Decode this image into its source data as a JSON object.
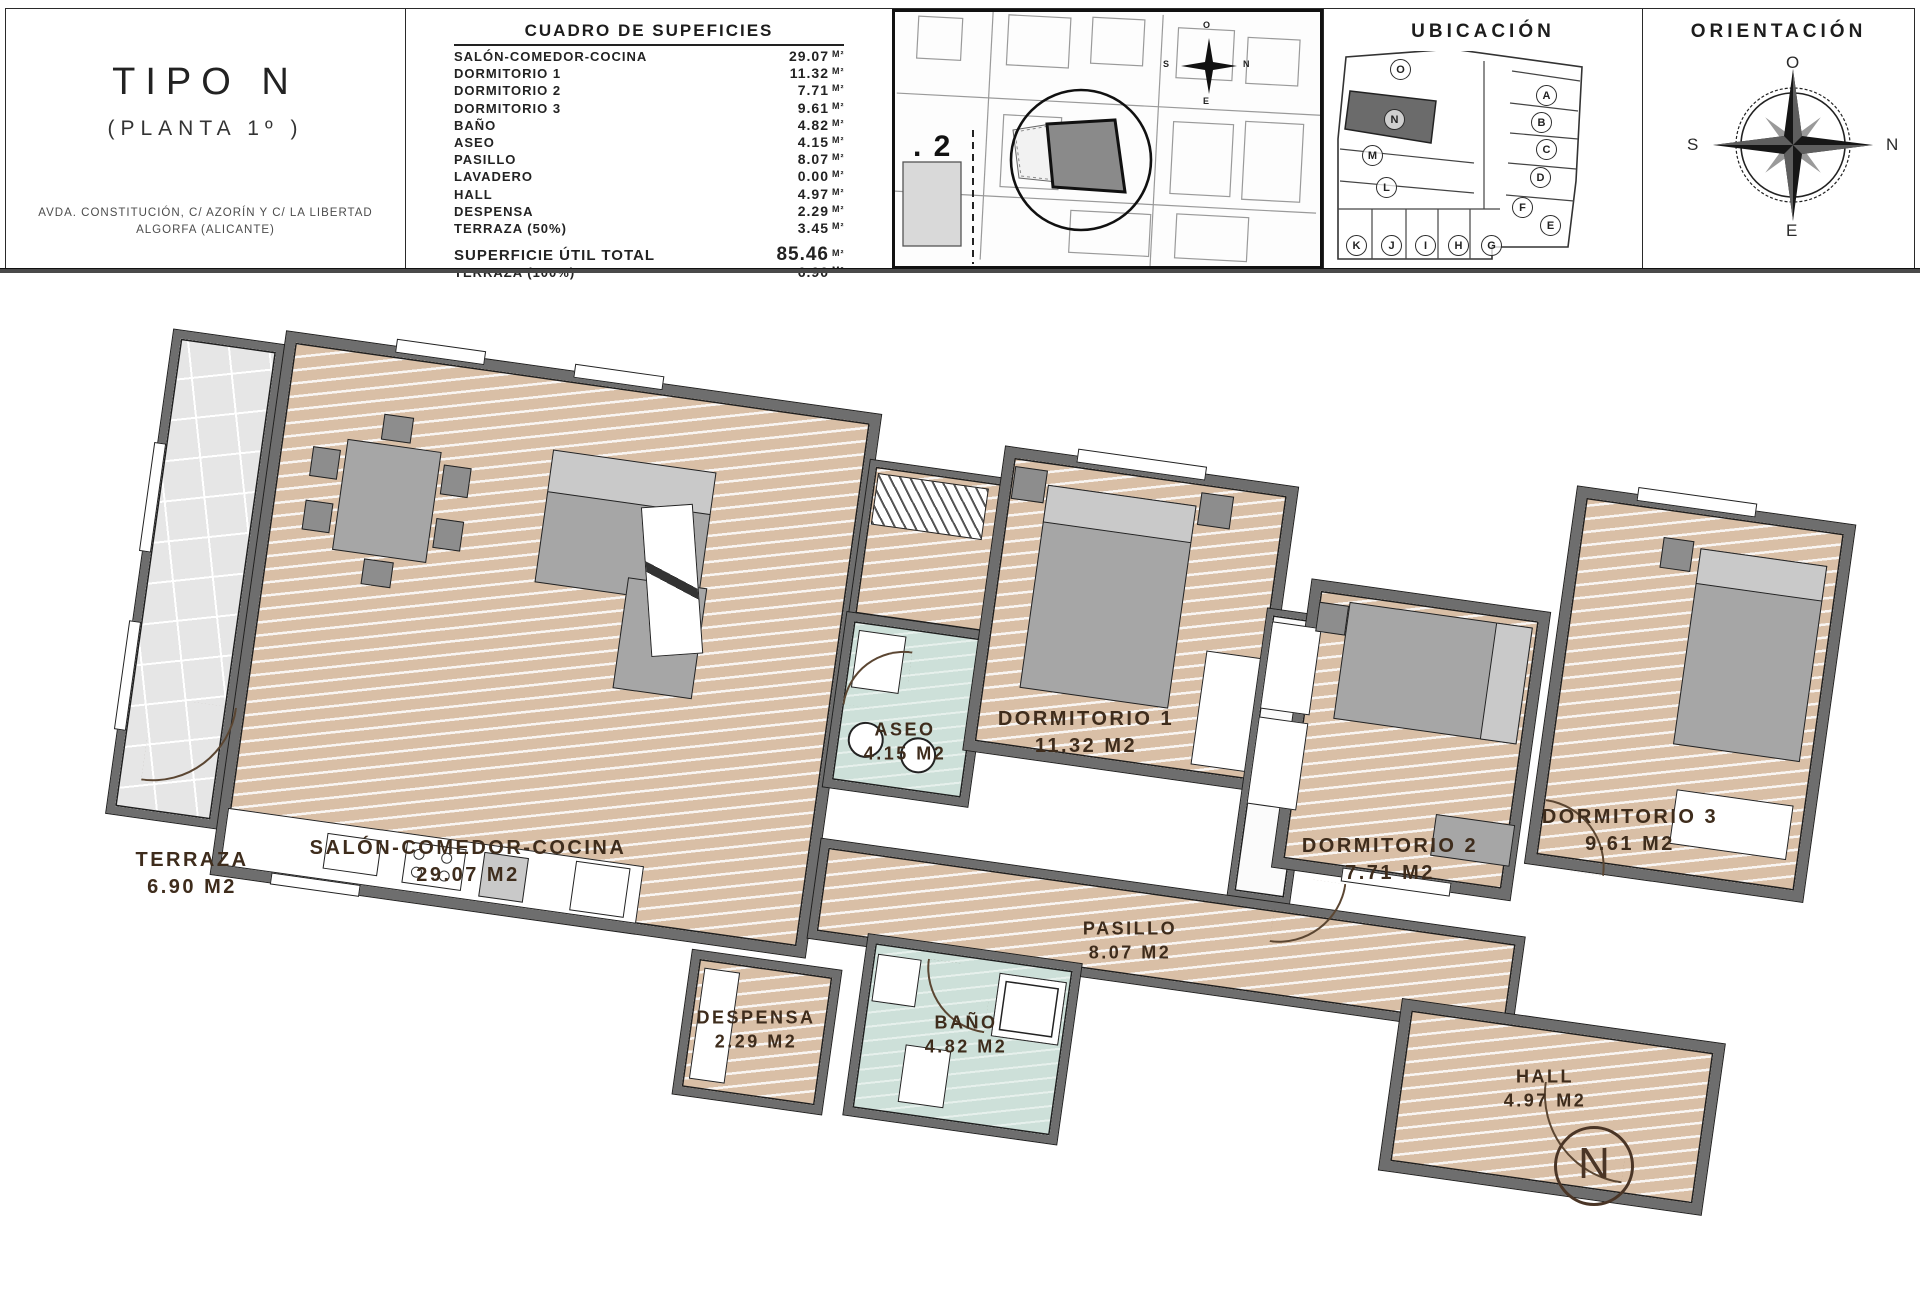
{
  "header": {
    "title": "TIPO N",
    "subtitle": "(PLANTA 1º )",
    "address_line1": "AVDA. CONSTITUCIÓN, C/ AZORÍN Y C/ LA LIBERTAD",
    "address_line2": "ALGORFA (ALICANTE)"
  },
  "areas": {
    "title": "CUADRO DE SUPEFICIES",
    "unit": "M²",
    "rows": [
      {
        "name": "SALÓN-COMEDOR-COCINA",
        "value": "29.07"
      },
      {
        "name": "DORMITORIO 1",
        "value": "11.32"
      },
      {
        "name": "DORMITORIO 2",
        "value": "7.71"
      },
      {
        "name": "DORMITORIO 3",
        "value": "9.61"
      },
      {
        "name": "BAÑO",
        "value": "4.82"
      },
      {
        "name": "ASEO",
        "value": "4.15"
      },
      {
        "name": "PASILLO",
        "value": "8.07"
      },
      {
        "name": "LAVADERO",
        "value": "0.00"
      },
      {
        "name": "HALL",
        "value": "4.97"
      },
      {
        "name": "DESPENSA",
        "value": "2.29"
      },
      {
        "name": "TERRAZA (50%)",
        "value": "3.45"
      }
    ],
    "totals": [
      {
        "name": "SUPERFICIE ÚTIL TOTAL",
        "value": "85.46"
      },
      {
        "name": "TERRAZA (100%)",
        "value": "6.90"
      }
    ]
  },
  "siteplan": {
    "block_label": ". 2",
    "compass": {
      "top": "O",
      "right": "N",
      "bottom": "E",
      "left": "S"
    }
  },
  "ubicacion": {
    "title": "UBICACIÓN",
    "highlighted_unit": "N",
    "units": [
      "O",
      "N",
      "M",
      "L",
      "K",
      "J",
      "I",
      "H",
      "G",
      "A",
      "B",
      "C",
      "D",
      "F",
      "E"
    ]
  },
  "orientacion": {
    "title": "ORIENTACIÓN",
    "compass": {
      "top": "O",
      "right": "N",
      "bottom": "E",
      "left": "S"
    }
  },
  "plan": {
    "entrance_marker": "N",
    "rooms": [
      {
        "id": "terraza",
        "name": "TERRAZA",
        "area": "6.90 M2"
      },
      {
        "id": "salon",
        "name": "SALÓN-COMEDOR-COCINA",
        "area": "29.07 M2"
      },
      {
        "id": "aseo",
        "name": "ASEO",
        "area": "4.15 M2"
      },
      {
        "id": "dorm1",
        "name": "DORMITORIO 1",
        "area": "11.32 M2"
      },
      {
        "id": "dorm2",
        "name": "DORMITORIO 2",
        "area": "7.71 M2"
      },
      {
        "id": "dorm3",
        "name": "DORMITORIO 3",
        "area": "9.61 M2"
      },
      {
        "id": "pasillo",
        "name": "PASILLO",
        "area": "8.07 M2"
      },
      {
        "id": "despensa",
        "name": "DESPENSA",
        "area": "2.29 M2"
      },
      {
        "id": "bano",
        "name": "BAÑO",
        "area": "4.82 M2"
      },
      {
        "id": "hall",
        "name": "HALL",
        "area": "4.97 M2"
      }
    ]
  },
  "colors": {
    "wood_floor": "#d9bfa6",
    "wet_floor": "#cde0d9",
    "terrace_floor": "#e6e6e6",
    "wall": "#6e6e6e",
    "label_text": "#3e2c1c"
  }
}
